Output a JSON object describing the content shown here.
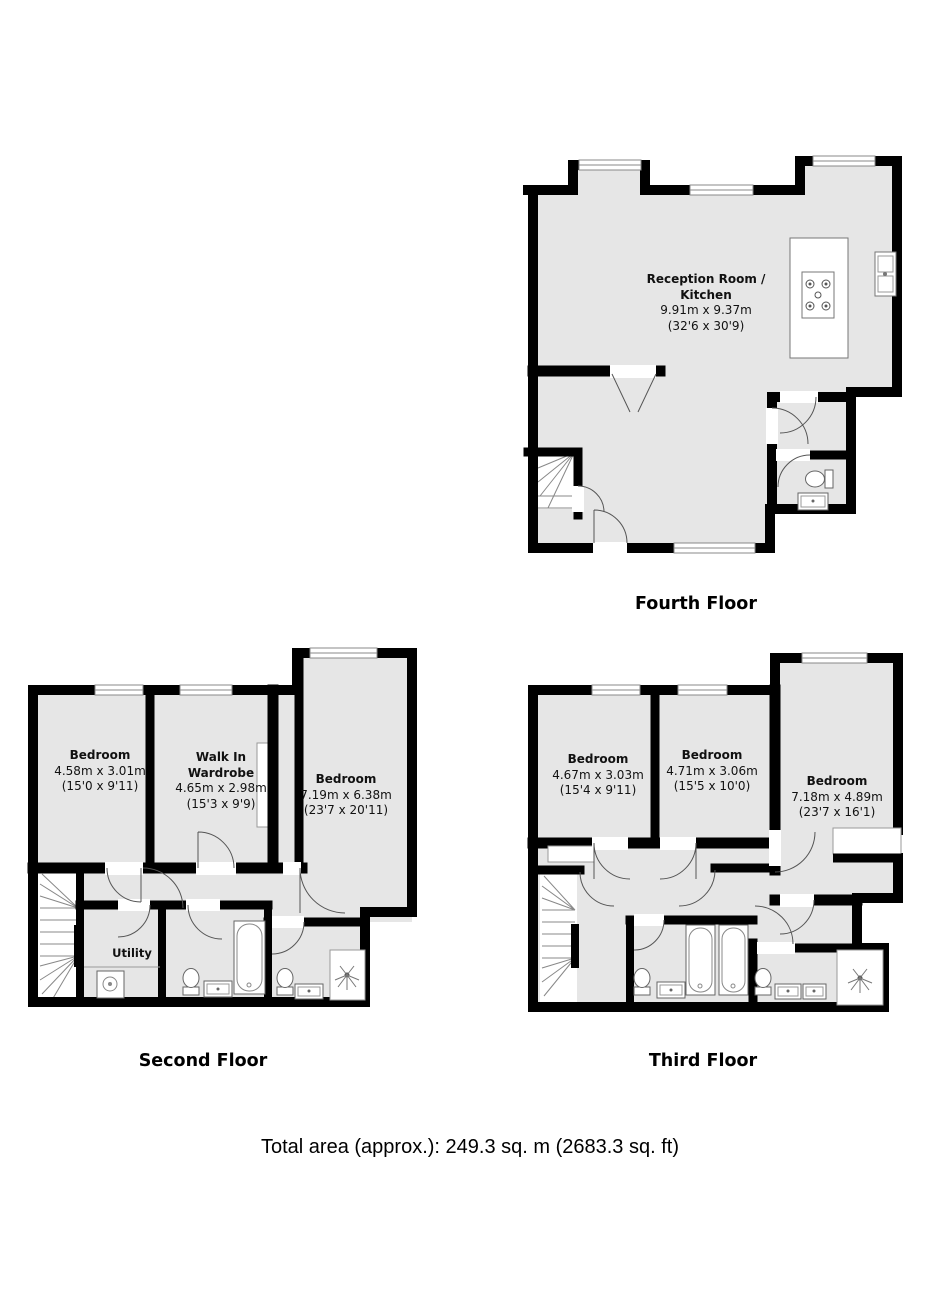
{
  "fourth": {
    "title": "Fourth Floor",
    "reception": {
      "name1": "Reception Room /",
      "name2": "Kitchen",
      "m": "9.91m x 9.37m",
      "ft": "(32'6 x 30'9)"
    }
  },
  "second": {
    "title": "Second Floor",
    "bedroom1": {
      "name": "Bedroom",
      "m": "4.58m x 3.01m",
      "ft": "(15'0 x 9'11)"
    },
    "wardrobe": {
      "name1": "Walk In",
      "name2": "Wardrobe",
      "m": "4.65m x 2.98m",
      "ft": "(15'3 x 9'9)"
    },
    "bedroom2": {
      "name": "Bedroom",
      "m": "7.19m x 6.38m",
      "ft": "(23'7 x 20'11)"
    },
    "utility": {
      "name": "Utility"
    }
  },
  "third": {
    "title": "Third Floor",
    "bedroom1": {
      "name": "Bedroom",
      "m": "4.67m x 3.03m",
      "ft": "(15'4 x 9'11)"
    },
    "bedroom2": {
      "name": "Bedroom",
      "m": "4.71m x 3.06m",
      "ft": "(15'5 x 10'0)"
    },
    "bedroom3": {
      "name": "Bedroom",
      "m": "7.18m x 4.89m",
      "ft": "(23'7 x 16'1)"
    }
  },
  "footer": {
    "total_area": "Total area (approx.): 249.3 sq. m (2683.3 sq. ft)"
  },
  "colors": {
    "wall": "#000000",
    "room_fill": "#e6e6e6",
    "fixture_line": "#707070",
    "door_arc": "#555555"
  },
  "icons": {
    "toilet": "toilet-icon",
    "bathtub": "bathtub-icon",
    "sink": "sink-icon",
    "shower": "shower-sprinkler-icon",
    "stairs": "stairs-icon",
    "hob": "hob-icon",
    "washer": "washing-machine-icon",
    "window": "window-icon",
    "door": "door-arc-icon"
  }
}
